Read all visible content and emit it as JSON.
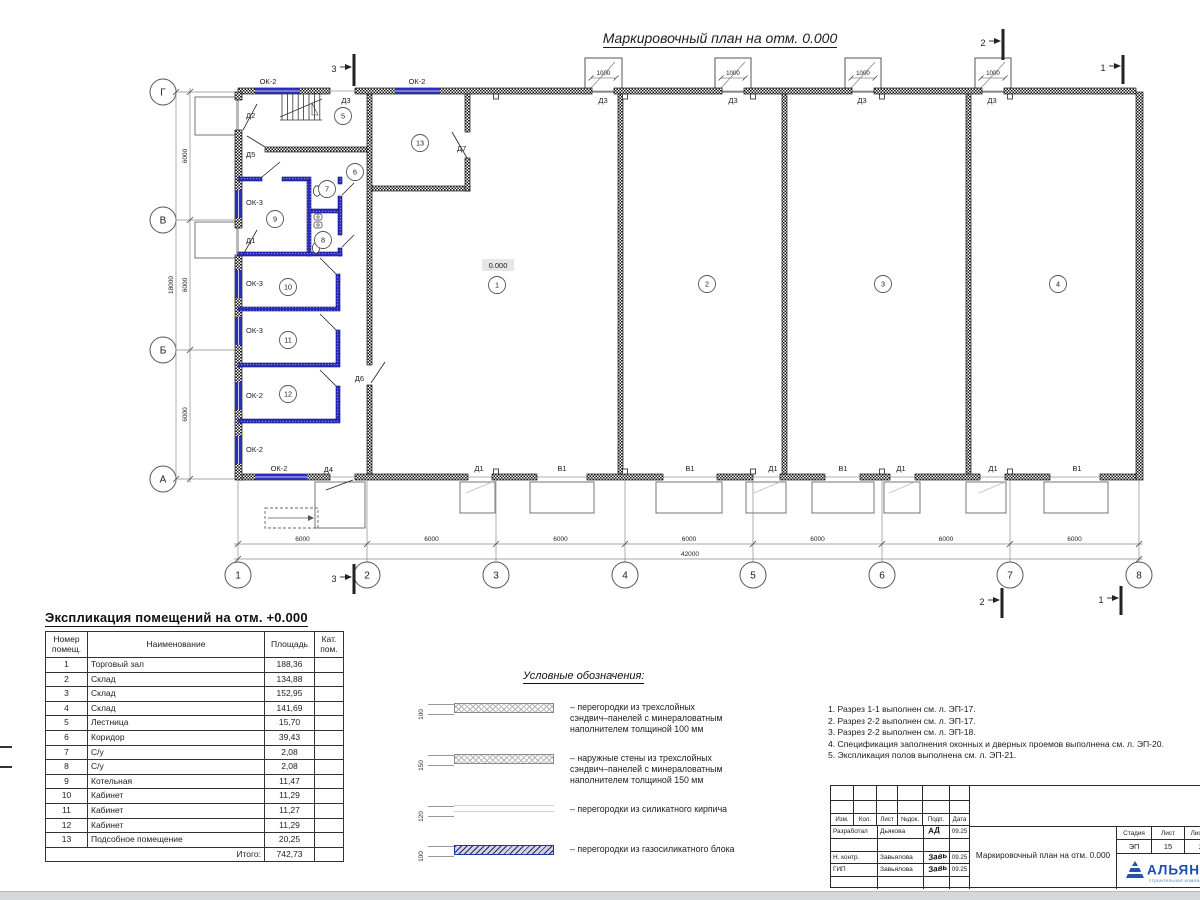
{
  "title": "Маркировочный план на отм. 0.000",
  "plan": {
    "elevation": {
      "text": "0.000",
      "x": 498,
      "y": 268
    },
    "axes_letters": [
      {
        "label": "Г",
        "y": 92
      },
      {
        "label": "В",
        "y": 220
      },
      {
        "label": "Б",
        "y": 350
      },
      {
        "label": "А",
        "y": 479
      }
    ],
    "axes_numbers": [
      {
        "label": "1",
        "x": 238
      },
      {
        "label": "2",
        "x": 367
      },
      {
        "label": "3",
        "x": 496
      },
      {
        "label": "4",
        "x": 625
      },
      {
        "label": "5",
        "x": 753
      },
      {
        "label": "6",
        "x": 882
      },
      {
        "label": "7",
        "x": 1010
      },
      {
        "label": "8",
        "x": 1139
      }
    ],
    "dim_bottom": {
      "segment_label": "6000",
      "total_label": "42000"
    },
    "dim_left": {
      "segment_label": "6000",
      "total_label": "18000"
    },
    "canopy_dim": "1000",
    "room_bubbles": [
      {
        "n": "1",
        "x": 497,
        "y": 285
      },
      {
        "n": "2",
        "x": 707,
        "y": 284
      },
      {
        "n": "3",
        "x": 883,
        "y": 284
      },
      {
        "n": "4",
        "x": 1058,
        "y": 284
      },
      {
        "n": "5",
        "x": 343,
        "y": 116
      },
      {
        "n": "6",
        "x": 355,
        "y": 172
      },
      {
        "n": "7",
        "x": 327,
        "y": 189
      },
      {
        "n": "8",
        "x": 323,
        "y": 240
      },
      {
        "n": "9",
        "x": 275,
        "y": 219
      },
      {
        "n": "10",
        "x": 288,
        "y": 287
      },
      {
        "n": "11",
        "x": 288,
        "y": 340
      },
      {
        "n": "12",
        "x": 288,
        "y": 394
      },
      {
        "n": "13",
        "x": 420,
        "y": 143
      }
    ],
    "labels": [
      {
        "t": "ОК-2",
        "x": 268,
        "y": 84
      },
      {
        "t": "ОК-2",
        "x": 417,
        "y": 84
      },
      {
        "t": "Д3",
        "x": 346,
        "y": 103
      },
      {
        "t": "Д3",
        "x": 603,
        "y": 103
      },
      {
        "t": "Д3",
        "x": 733,
        "y": 103
      },
      {
        "t": "Д3",
        "x": 862,
        "y": 103
      },
      {
        "t": "Д3",
        "x": 992,
        "y": 103
      },
      {
        "t": "Д2",
        "x": 246,
        "y": 118,
        "a": "start"
      },
      {
        "t": "Д5",
        "x": 246,
        "y": 157,
        "a": "start"
      },
      {
        "t": "Д1",
        "x": 246,
        "y": 243,
        "a": "start"
      },
      {
        "t": "Д7",
        "x": 457,
        "y": 151,
        "a": "start"
      },
      {
        "t": "Д6",
        "x": 364,
        "y": 381,
        "a": "end"
      },
      {
        "t": "Д4",
        "x": 333,
        "y": 472,
        "a": "end"
      },
      {
        "t": "ОК-3",
        "x": 246,
        "y": 205,
        "a": "start"
      },
      {
        "t": "ОК-3",
        "x": 246,
        "y": 286,
        "a": "start"
      },
      {
        "t": "ОК-3",
        "x": 246,
        "y": 333,
        "a": "start"
      },
      {
        "t": "ОК-2",
        "x": 246,
        "y": 398,
        "a": "start"
      },
      {
        "t": "ОК-2",
        "x": 246,
        "y": 452,
        "a": "start"
      },
      {
        "t": "ОК-2",
        "x": 279,
        "y": 471
      },
      {
        "t": "Д1",
        "x": 479,
        "y": 471
      },
      {
        "t": "В1",
        "x": 562,
        "y": 471
      },
      {
        "t": "В1",
        "x": 690,
        "y": 471
      },
      {
        "t": "Д1",
        "x": 773,
        "y": 471
      },
      {
        "t": "В1",
        "x": 843,
        "y": 471
      },
      {
        "t": "Д1",
        "x": 901,
        "y": 471
      },
      {
        "t": "Д1",
        "x": 993,
        "y": 471
      },
      {
        "t": "В1",
        "x": 1077,
        "y": 471
      }
    ],
    "section_marks": [
      {
        "label": "3",
        "x": 334,
        "y": 70,
        "bx": 354,
        "y1": 54,
        "y2": 86
      },
      {
        "label": "3",
        "x": 334,
        "y": 580,
        "bx": 354,
        "y1": 564,
        "y2": 594
      },
      {
        "label": "2",
        "x": 983,
        "y": 44,
        "bx": 1003,
        "y1": 29,
        "y2": 60
      },
      {
        "label": "1",
        "x": 1103,
        "y": 69,
        "bx": 1123,
        "y1": 55,
        "y2": 84
      },
      {
        "label": "2",
        "x": 982,
        "y": 603,
        "bx": 1002,
        "y1": 588,
        "y2": 618
      },
      {
        "label": "1",
        "x": 1101,
        "y": 601,
        "bx": 1121,
        "y1": 586,
        "y2": 615
      }
    ]
  },
  "explication": {
    "title": "Экспликация помещений на отм. +0.000",
    "headers": [
      "Номер\nпомещ.",
      "Наименование",
      "Площадь",
      "Кат.\nпом."
    ],
    "rows": [
      [
        "1",
        "Торговый зал",
        "188,36",
        ""
      ],
      [
        "2",
        "Склад",
        "134,88",
        ""
      ],
      [
        "3",
        "Склад",
        "152,95",
        ""
      ],
      [
        "4",
        "Склад",
        "141,69",
        ""
      ],
      [
        "5",
        "Лестница",
        "15,70",
        ""
      ],
      [
        "6",
        "Коридор",
        "39,43",
        ""
      ],
      [
        "7",
        "С/у",
        "2,08",
        ""
      ],
      [
        "8",
        "С/у",
        "2,08",
        ""
      ],
      [
        "9",
        "Котельная",
        "11,47",
        ""
      ],
      [
        "10",
        "Кабинет",
        "11,29",
        ""
      ],
      [
        "11",
        "Кабинет",
        "11,27",
        ""
      ],
      [
        "12",
        "Кабинет",
        "11,29",
        ""
      ],
      [
        "13",
        "Подсобное помещение",
        "20,25",
        ""
      ]
    ],
    "total_label": "Итого:",
    "total_value": "742,73"
  },
  "legend": {
    "title": "Условные обозначения:",
    "items": [
      {
        "dim": "100",
        "style": "sw-sandwich",
        "text": "– перегородки из трехслойных\nсэндвич–панелей с минераловатным\nнаполнителем толщиной 100 мм"
      },
      {
        "dim": "150",
        "style": "sw-sandwich",
        "text": "– наружные стены из трехслойных\nсэндвич–панелей с минераловатным\nнаполнителем толщиной 150 мм"
      },
      {
        "dim": "120",
        "style": "sw-brick",
        "text": "– перегородки из силикатного кирпича"
      },
      {
        "dim": "100",
        "style": "sw-gas",
        "text": "– перегородки из газосиликатного блока"
      }
    ]
  },
  "notes": {
    "lines": [
      "1. Разрез 1-1 выполнен см. л. ЭП-17.",
      "2. Разрез 2-2 выполнен см. л. ЭП-17.",
      "3. Разрез 2-2 выполнен см. л. ЭП-18.",
      "4. Спецификация заполнения оконных и дверных проемов выполнена см. л. ЭП-20.",
      "5. Экспликация полов выполнена см. л. ЭП-21."
    ]
  },
  "titleblock": {
    "header_cols": [
      "Изм.",
      "Кол.",
      "Лист",
      "№док.",
      "Подп.",
      "Дата"
    ],
    "rows": [
      {
        "role": "Разработал",
        "name": "Дьякова",
        "sig": "АД",
        "date": "09.25"
      },
      {
        "role": "",
        "name": "",
        "sig": "",
        "date": ""
      },
      {
        "role": "Н. контр.",
        "name": "Завьялова",
        "sig": "Завь",
        "date": "09.25"
      },
      {
        "role": "ГИП",
        "name": "Завьялова",
        "sig": "Завь",
        "date": "09.25"
      },
      {
        "role": "",
        "name": "",
        "sig": "",
        "date": ""
      }
    ],
    "doc_title": "Маркировочный план на отм. 0.000",
    "stage_label": "Стадия",
    "sheet_label": "Лист",
    "sheets_label": "Листов",
    "stage": "ЭП",
    "sheet": "15",
    "sheets": "2",
    "company": "АЛЬЯНС",
    "company_sub": "строительная компания",
    "brand_color": "#1a4fae"
  },
  "colors": {
    "wall_dark": "#161616",
    "partition_blue": "#2d2dbb",
    "dim_gray": "#8a8a8a",
    "brick_pink": "#efc0e6"
  }
}
